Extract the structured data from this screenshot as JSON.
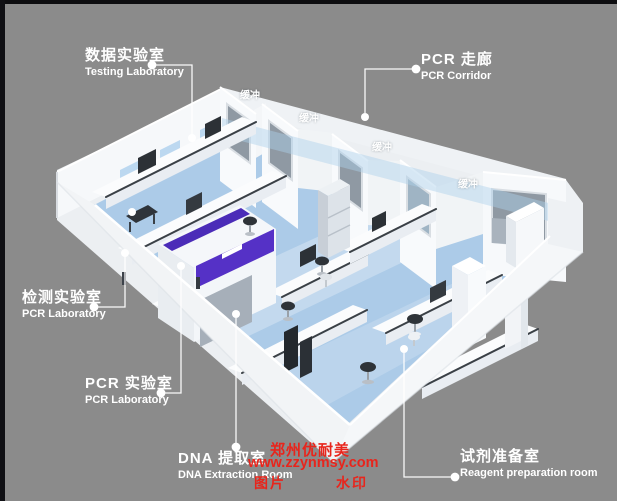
{
  "colors": {
    "bg": "#8b8b8b",
    "floor": "#accbe8",
    "purple": "#5531c6",
    "red": "#e8251c",
    "label": "#ffffff"
  },
  "room_labels": [
    {
      "id": "testing-laboratory",
      "zh": "数据实验室",
      "en": "Testing Laboratory"
    },
    {
      "id": "pcr-corridor",
      "zh": "PCR 走廊",
      "en": "PCR Corridor"
    },
    {
      "id": "detection-laboratory",
      "zh": "检测实验室",
      "en": "PCR Laboratory"
    },
    {
      "id": "pcr-laboratory",
      "zh": "PCR 实验室",
      "en": "PCR Laboratory"
    },
    {
      "id": "dna-extraction-room",
      "zh": "DNA 提取室",
      "en": "DNA Extraction Room"
    },
    {
      "id": "reagent-preparation-room",
      "zh": "试剂准备室",
      "en": "Reagent preparation room"
    }
  ],
  "buffer_rooms": [
    "缓冲",
    "缓冲",
    "缓冲",
    "缓冲"
  ],
  "watermarks": {
    "company": "郑州优耐美",
    "website": "www.zzynmsy.com",
    "tag_left": "图片",
    "tag_right": "水印",
    "center_logo": "WM"
  }
}
